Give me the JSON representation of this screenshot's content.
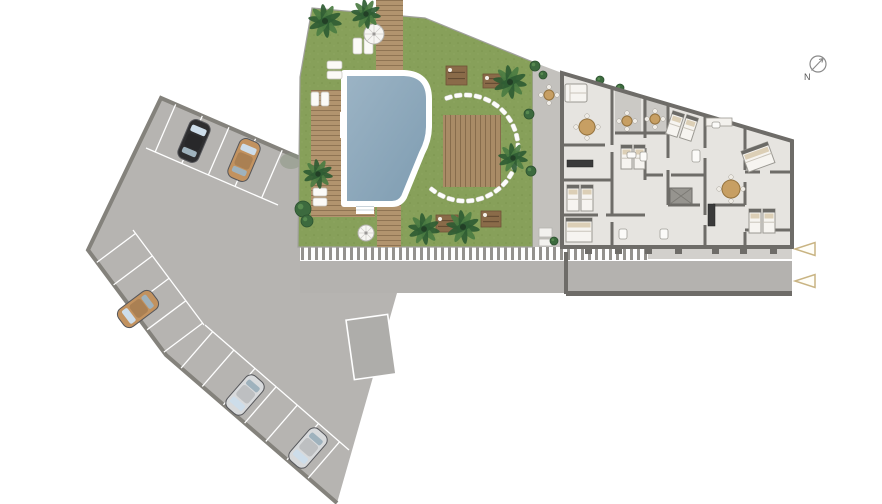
{
  "labels": {
    "compass": "N"
  },
  "colors": {
    "background": "#ffffff",
    "grass": "#87a05a",
    "grass_dot": "#7b944e",
    "pool_water": "#8aa8bc",
    "pool_edge": "#ffffff",
    "deck_wood": "#b2946e",
    "deck_line": "#8f7453",
    "parking_fill": "#b6b4b1",
    "parking_border": "#84827c",
    "stall_line": "#ffffff",
    "building_floor": "#e6e4e0",
    "wall": "#6e6c68",
    "terrace": "#c3c1bd",
    "palm_dark": "#2f5c33",
    "palm_light": "#4b7c42",
    "car_black": "#2e2e30",
    "car_tan": "#c2925f",
    "car_silver": "#d8dadc",
    "arrow_stroke": "#c9b483",
    "compass_stroke": "#8a8a8a",
    "zebra_stripe": "#94928e"
  },
  "parking": {
    "cars": [
      {
        "name": "black-car",
        "color": "#2e2e30",
        "x": 194,
        "y": 141,
        "rot": 23
      },
      {
        "name": "tan-car-top",
        "color": "#c2925f",
        "x": 244,
        "y": 160,
        "rot": 23
      },
      {
        "name": "tan-car-left",
        "color": "#c2925f",
        "x": 138,
        "y": 309,
        "rot": 233
      },
      {
        "name": "silver-car-1",
        "color": "#d8dadc",
        "x": 245,
        "y": 395,
        "rot": 221
      },
      {
        "name": "silver-car-2",
        "color": "#d8dadc",
        "x": 308,
        "y": 448,
        "rot": 221
      }
    ],
    "stall_rows": [
      {
        "ax": 161,
        "ay": 98,
        "dx": 0.918,
        "dy": 0.396,
        "nx": -0.396,
        "ny": 0.918,
        "depth": 52,
        "ks": [
          16,
          45,
          74,
          103,
          132
        ],
        "base": [
          146,
          148,
          278,
          205
        ]
      },
      {
        "ax": 92,
        "ay": 256,
        "dx": 0.599,
        "dy": 0.801,
        "nx": 0.801,
        "ny": -0.599,
        "depth": 48,
        "ks": [
          8,
          36,
          64,
          92,
          120
        ],
        "base": [
          133,
          230,
          204,
          325
        ]
      },
      {
        "ax": 166,
        "ay": 355,
        "dx": 0.756,
        "dy": 0.655,
        "nx": 0.655,
        "ny": -0.756,
        "depth": 48,
        "ks": [
          20,
          48,
          76,
          104,
          132,
          160,
          188
        ],
        "base": [
          205,
          325,
          349,
          450
        ]
      }
    ],
    "single_stall": {
      "x": 350,
      "y": 317,
      "w": 42,
      "h": 60,
      "rot": -8
    }
  },
  "garden": {
    "palms": [
      [
        325,
        21,
        17
      ],
      [
        366,
        14,
        15
      ],
      [
        318,
        174,
        15
      ],
      [
        424,
        229,
        16
      ],
      [
        463,
        227,
        17
      ],
      [
        510,
        82,
        17
      ],
      [
        513,
        158,
        15
      ]
    ],
    "bushes": [
      [
        303,
        209,
        8
      ],
      [
        307,
        221,
        6
      ],
      [
        535,
        66,
        5
      ],
      [
        529,
        114,
        5
      ],
      [
        531,
        171,
        5
      ],
      [
        543,
        75,
        4
      ],
      [
        620,
        88,
        4
      ],
      [
        554,
        241,
        4
      ],
      [
        600,
        80,
        4
      ],
      [
        781,
        148,
        4
      ]
    ],
    "stones": {
      "cx": 465,
      "cy": 148,
      "r": 53,
      "a0": -108,
      "a1": 127,
      "n": 23,
      "w": 8,
      "h": 4.5
    },
    "white_loungers": [
      [
        353,
        38,
        9,
        16
      ],
      [
        364,
        38,
        9,
        16
      ],
      [
        327,
        61,
        15,
        8
      ],
      [
        327,
        71,
        15,
        8
      ],
      [
        311,
        92,
        8,
        14
      ],
      [
        321,
        92,
        8,
        14
      ],
      [
        313,
        188,
        14,
        8
      ],
      [
        313,
        198,
        14,
        8
      ]
    ],
    "umbrellas": [
      [
        374,
        34,
        10
      ],
      [
        366,
        233,
        8
      ]
    ],
    "wood_loungers": [
      [
        446,
        66,
        21,
        19
      ],
      [
        483,
        74,
        19,
        14
      ],
      [
        436,
        215,
        22,
        17
      ],
      [
        481,
        211,
        20,
        16
      ]
    ]
  },
  "building": {
    "beds": [
      [
        567,
        185,
        12,
        26,
        0
      ],
      [
        581,
        185,
        12,
        26,
        0
      ],
      [
        566,
        218,
        26,
        24,
        0
      ],
      [
        621,
        145,
        11,
        24,
        0
      ],
      [
        634,
        145,
        11,
        24,
        0
      ],
      [
        669,
        112,
        12,
        24,
        18
      ],
      [
        683,
        116,
        12,
        24,
        18
      ],
      [
        744,
        146,
        28,
        22,
        -20
      ],
      [
        749,
        209,
        12,
        24,
        0
      ],
      [
        763,
        209,
        12,
        24,
        0
      ]
    ],
    "tables": [
      [
        587,
        127,
        8
      ],
      [
        731,
        189,
        9
      ],
      [
        627,
        121,
        5
      ],
      [
        655,
        119,
        5
      ],
      [
        549,
        95,
        5
      ]
    ],
    "sofas": [
      [
        565,
        84,
        22,
        18
      ]
    ],
    "counters": [
      [
        567,
        160,
        26,
        7
      ],
      [
        708,
        204,
        7,
        22
      ]
    ],
    "white_counters": [
      [
        706,
        118,
        26,
        8
      ]
    ],
    "baths": [
      [
        627,
        152,
        9,
        6
      ],
      [
        640,
        152,
        7,
        9
      ],
      [
        692,
        150,
        8,
        12
      ],
      [
        712,
        122,
        8,
        6
      ],
      [
        660,
        229,
        8,
        10
      ],
      [
        619,
        229,
        8,
        10
      ]
    ]
  },
  "markers": {
    "arrows": [
      [
        805,
        249
      ],
      [
        805,
        281
      ]
    ],
    "compass": {
      "x": 818,
      "y": 64,
      "r": 8
    }
  }
}
